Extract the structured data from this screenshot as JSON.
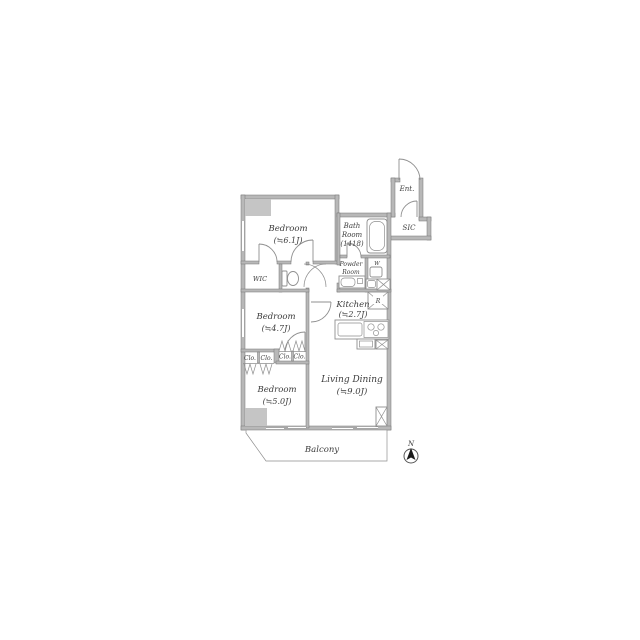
{
  "colors": {
    "wall": "#b8b8b8",
    "wall_edge": "#757575",
    "line": "#8f8f8f",
    "text": "#3c3c3c",
    "pillar": "#c5c5c5",
    "needle": "#1a1a1a"
  },
  "rooms": {
    "bedroom_main": {
      "name": "Bedroom",
      "size": "(≒6.1J)"
    },
    "bedroom_mid": {
      "name": "Bedroom",
      "size": "(≒4.7J)"
    },
    "bedroom_small": {
      "name": "Bedroom",
      "size": "(≒5.0J)"
    },
    "living_dining": {
      "name": "Living Dining",
      "size": "(≒9.0J)"
    },
    "kitchen": {
      "name": "Kitchen",
      "size": "(≒2.7J)"
    },
    "bath": {
      "name1": "Bath",
      "name2": "Room",
      "size": "(1418)"
    },
    "powder": {
      "name1": "Powder",
      "name2": "Room"
    },
    "entrance": {
      "name": "Ent."
    },
    "sic": {
      "name": "SIC"
    },
    "wic": {
      "name": "WIC"
    },
    "balcony": {
      "name": "Balcony"
    }
  },
  "markers": {
    "closet": "Clo.",
    "washer": "W",
    "refrigerator": "R",
    "north": "N"
  }
}
